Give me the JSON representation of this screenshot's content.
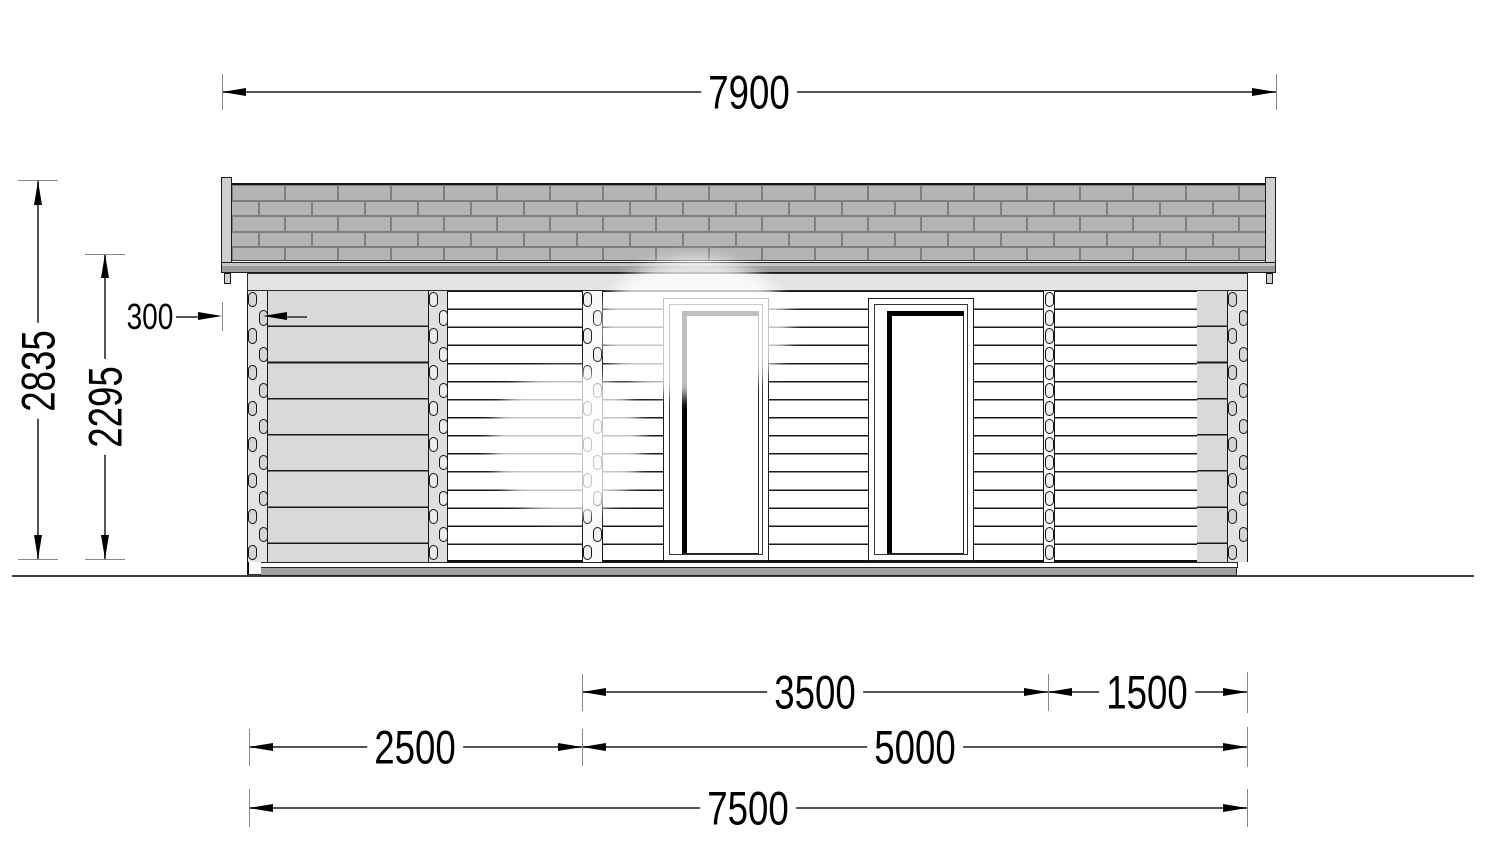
{
  "drawing": {
    "kind": "log-cabin-front-elevation",
    "dims": {
      "roof_width": "7900",
      "total_height": "2835",
      "wall_height": "2295",
      "roof_overhang": "300",
      "span_3500": "3500",
      "span_1500": "1500",
      "span_2500": "2500",
      "span_5000": "5000",
      "base_total": "7500"
    },
    "colors": {
      "shingle": "#b4b4b4",
      "shingle_line": "#7f7f7f",
      "fascia": "#9b9b9b",
      "wall_shaded": "#d9d9d9",
      "line": "#1a1a1a"
    }
  }
}
